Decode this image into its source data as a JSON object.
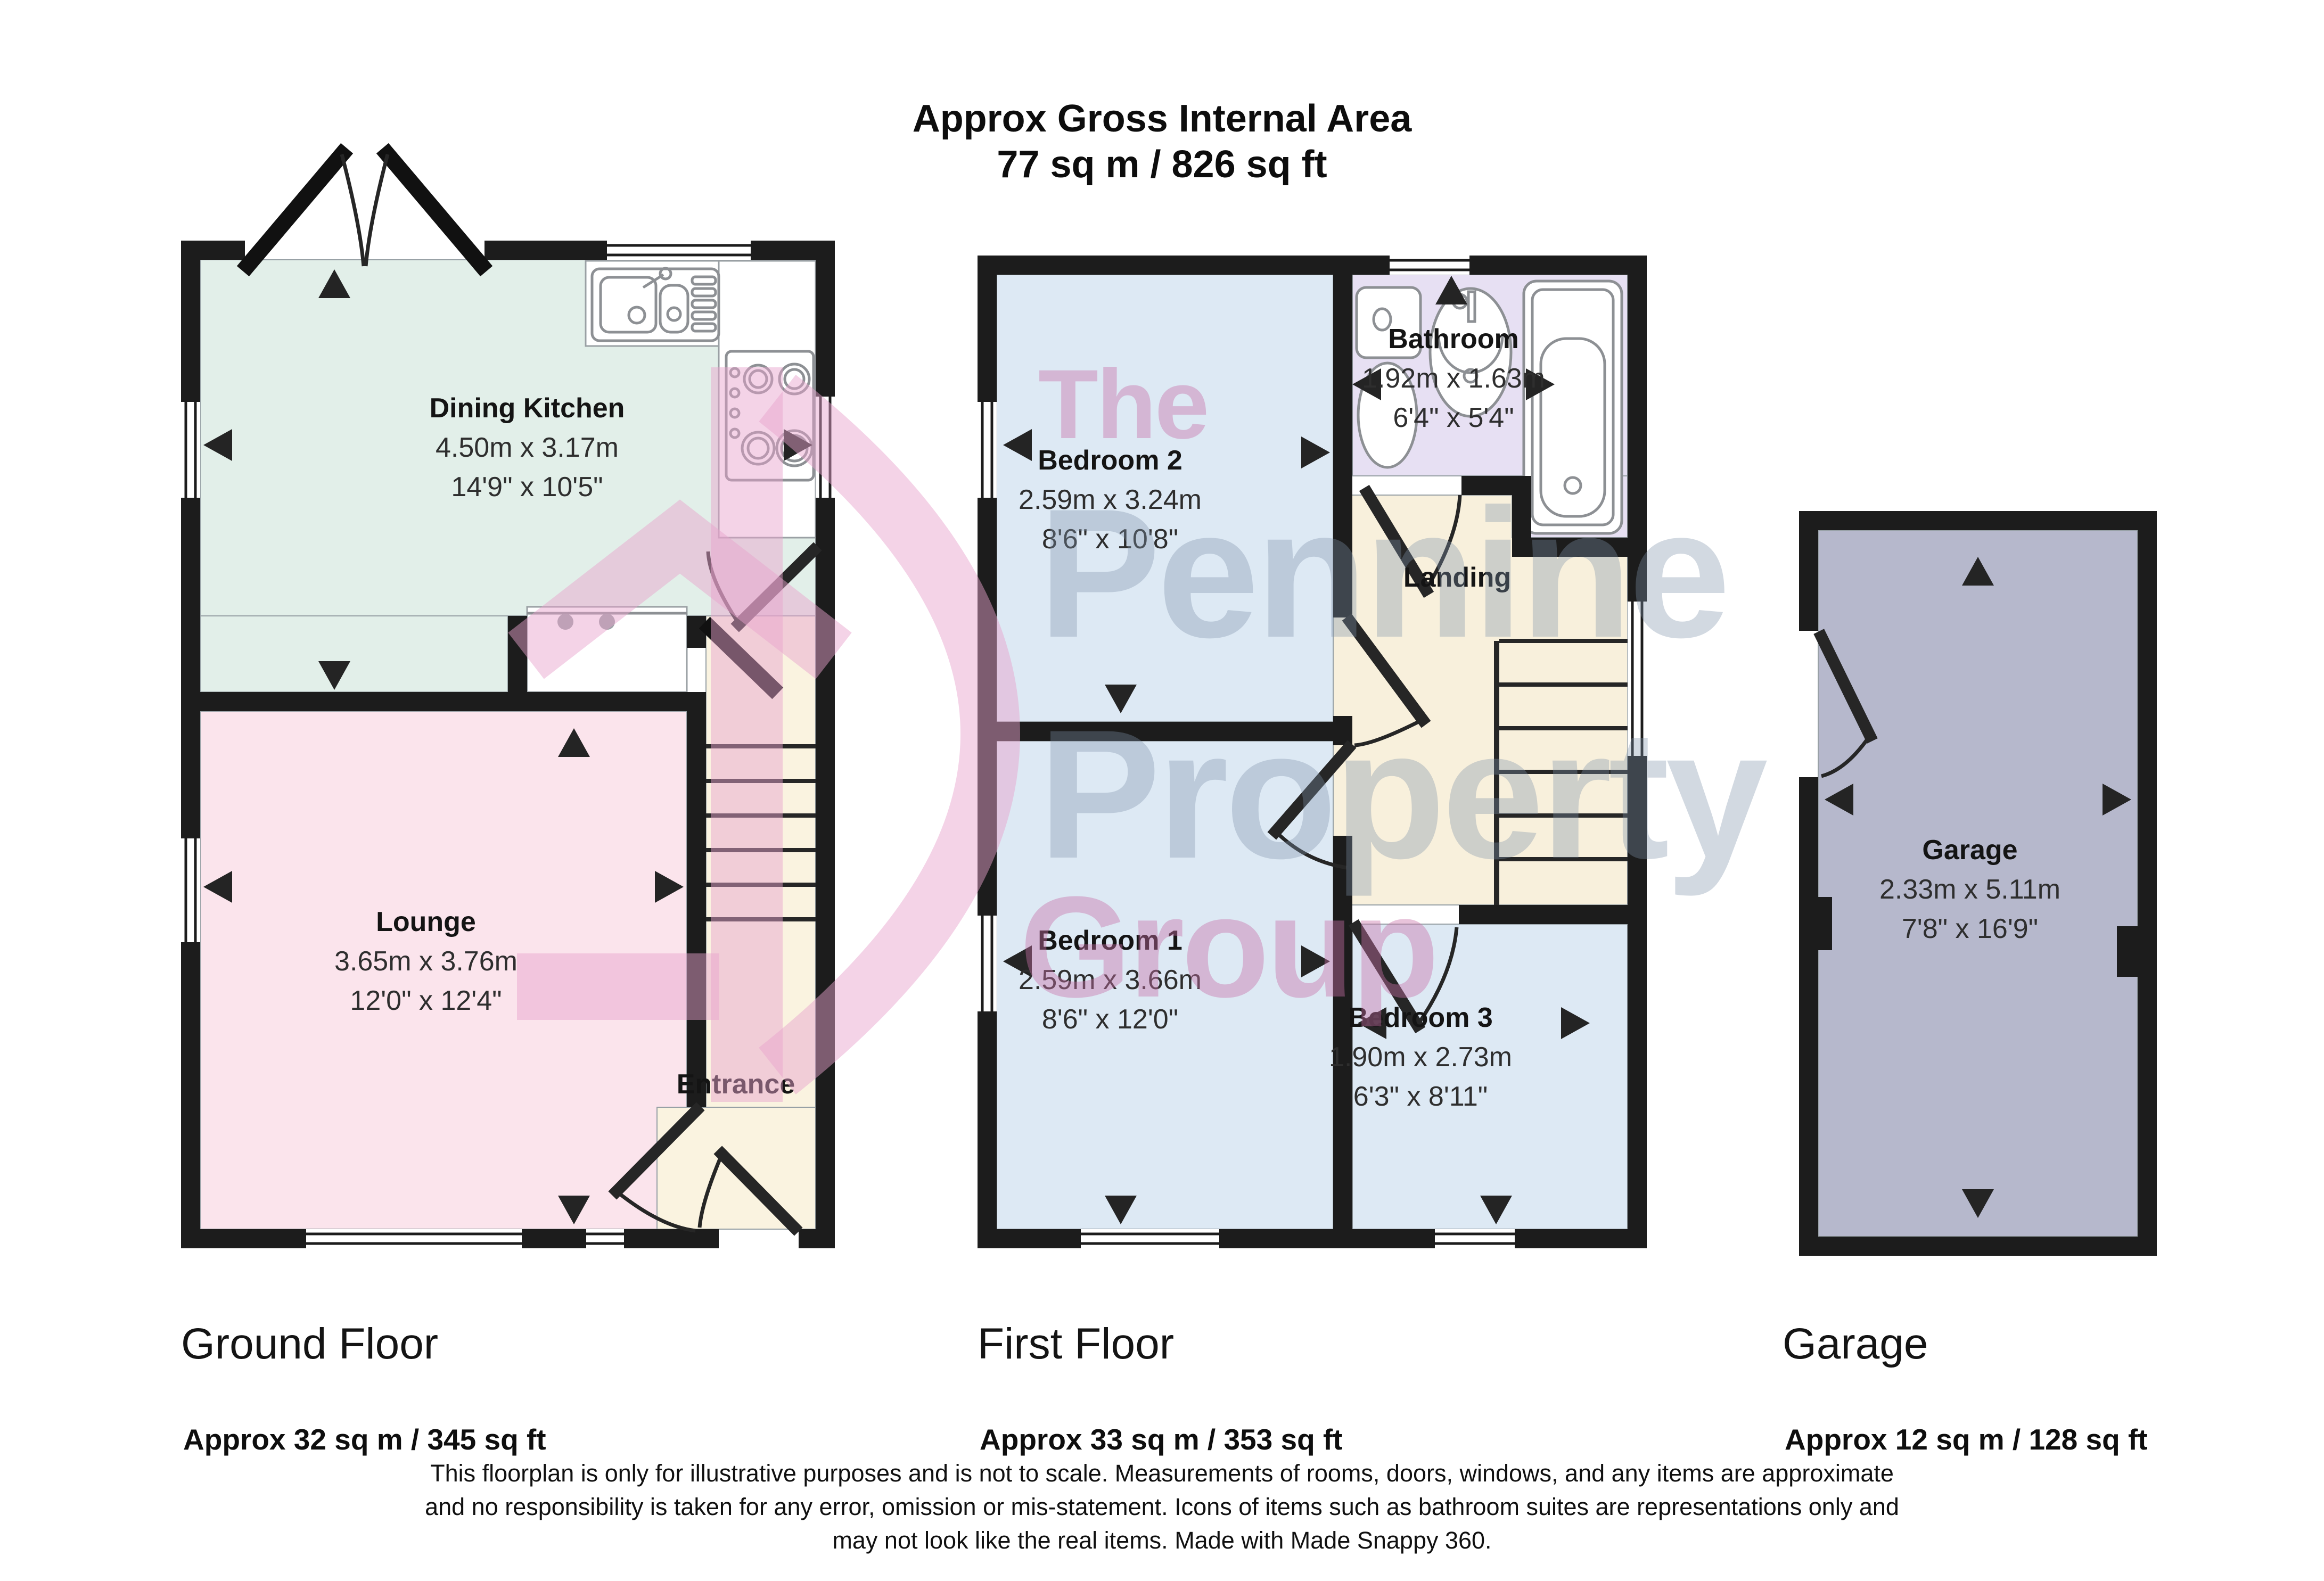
{
  "title": {
    "line1": "Approx Gross Internal Area",
    "line2": "77 sq m / 826 sq ft"
  },
  "rooms": {
    "dining_kitchen": {
      "name": "Dining Kitchen",
      "metric": "4.50m x 3.17m",
      "imperial": "14'9\" x 10'5\""
    },
    "lounge": {
      "name": "Lounge",
      "metric": "3.65m x 3.76m",
      "imperial": "12'0\" x 12'4\""
    },
    "entrance": {
      "name": "Entrance"
    },
    "bedroom2": {
      "name": "Bedroom 2",
      "metric": "2.59m x 3.24m",
      "imperial": "8'6\" x 10'8\""
    },
    "bathroom": {
      "name": "Bathroom",
      "metric": "1.92m x 1.63m",
      "imperial": "6'4\" x 5'4\""
    },
    "landing": {
      "name": "Landing"
    },
    "bedroom1": {
      "name": "Bedroom 1",
      "metric": "2.59m x 3.66m",
      "imperial": "8'6\" x 12'0\""
    },
    "bedroom3": {
      "name": "Bedroom 3",
      "metric": "1.90m x 2.73m",
      "imperial": "6'3\" x 8'11\""
    },
    "garage": {
      "name": "Garage",
      "metric": "2.33m x 5.11m",
      "imperial": "7'8\" x 16'9\""
    }
  },
  "floors": {
    "ground": {
      "label": "Ground Floor",
      "area": "Approx 32 sq m / 345 sq ft"
    },
    "first": {
      "label": "First Floor",
      "area": "Approx 33 sq m / 353 sq ft"
    },
    "garage": {
      "label": "Garage",
      "area": "Approx 12 sq m / 128 sq ft"
    }
  },
  "disclaimer": {
    "line1": "This floorplan is only for illustrative purposes and is not to scale. Measurements of rooms, doors, windows, and any items are approximate",
    "line2": "and no responsibility is taken for any error, omission or mis-statement. Icons of items such as bathroom suites are representations only and",
    "line3": "may not look like the real items. Made with Made Snappy 360."
  },
  "watermark": {
    "word1": "The",
    "word2": "Pennine",
    "word3": "Property",
    "word4": "Group",
    "pink": "#c770a8",
    "gray": "#7d91aa"
  },
  "colors": {
    "kitchen": "#e2efe9",
    "lounge": "#fbe4ec",
    "cream": "#faf3e0",
    "bedroom": "#dde9f4",
    "bathroom": "#e7e0f3",
    "landing": "#f8f0dc",
    "garage": "#b6b8cc",
    "wall": "#1c1c1c"
  }
}
